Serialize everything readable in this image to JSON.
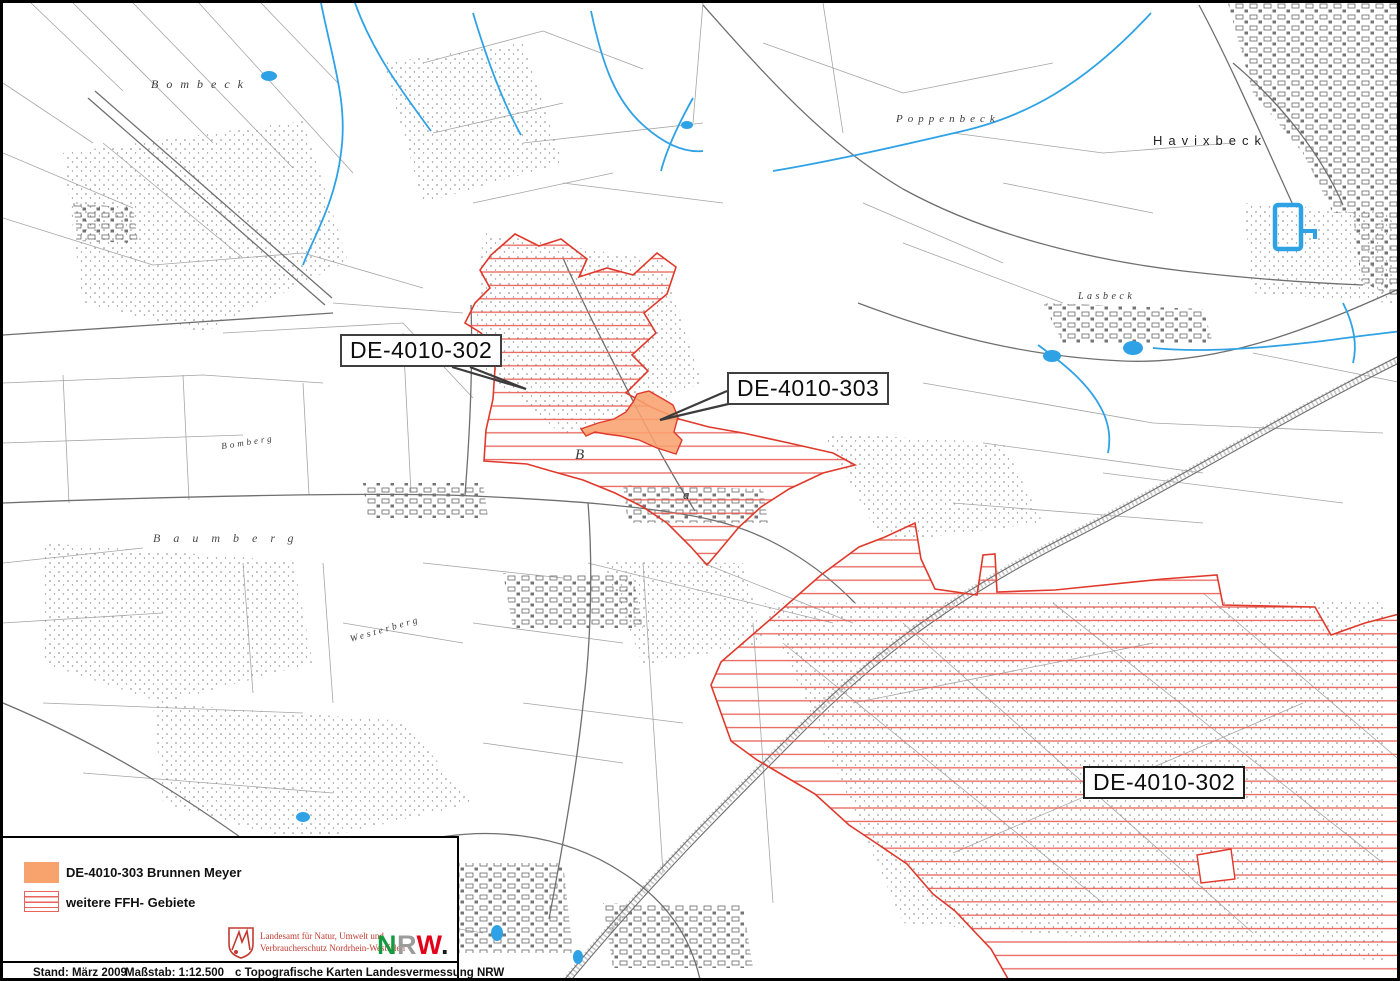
{
  "map": {
    "callouts": [
      {
        "id": "area-302-north",
        "label": "DE-4010-302"
      },
      {
        "id": "area-303",
        "label": "DE-4010-303"
      },
      {
        "id": "area-302-southeast",
        "label": "DE-4010-302"
      }
    ],
    "place_names": [
      {
        "name": "Bombeck"
      },
      {
        "name": "Poppenbeck"
      },
      {
        "name": "Havixbeck"
      },
      {
        "name": "Lasbeck"
      },
      {
        "name": "Baumberg"
      },
      {
        "name": "Bomberg"
      },
      {
        "name": "Westerberg"
      },
      {
        "name": "B"
      },
      {
        "name": "a"
      }
    ]
  },
  "legend": {
    "items": [
      {
        "swatch": "orange-fill",
        "label": "DE-4010-303 Brunnen Meyer",
        "color": "#F8A26E"
      },
      {
        "swatch": "red-hatch",
        "label": "weitere FFH- Gebiete",
        "color": "#E8635A"
      }
    ]
  },
  "logos": {
    "lanuv_line1": "Landesamt für Natur, Umwelt und",
    "lanuv_line2": "Verbraucherschutz Nordrhein-Westfalen",
    "nrw": {
      "n": "N",
      "r": "R",
      "w": "W",
      "dot": ".",
      "n_color": "#149A3F",
      "r_color": "#9C9C9C",
      "w_color": "#E2001A",
      "dot_color": "#1a1a1a"
    }
  },
  "footer": {
    "stand": "Stand: März 2009",
    "scale": "Maßstab: 1:12.500",
    "copyright": "c Topografische Karten Landesvermessung NRW"
  },
  "colors": {
    "ffh_hatch": "#E8635A",
    "ffh_border": "#E0392B",
    "brunnen_fill": "#F8A26E",
    "water": "#2FA2E6",
    "frame": "#000000"
  }
}
